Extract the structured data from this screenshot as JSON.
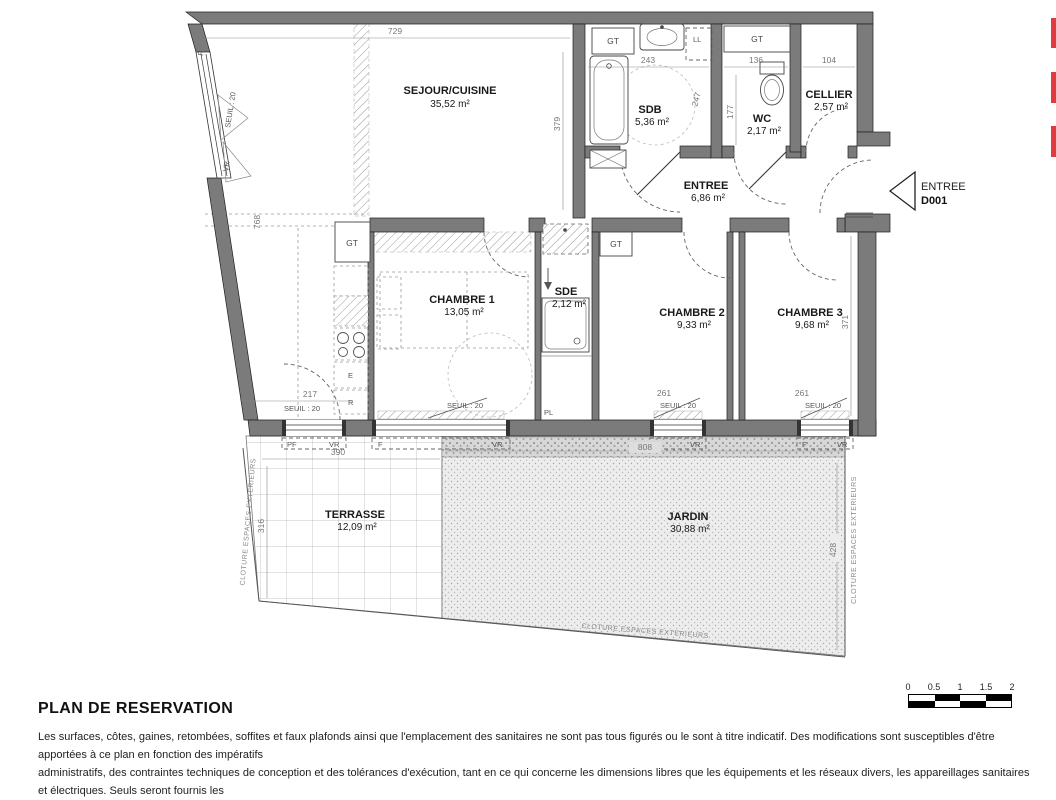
{
  "plan": {
    "rooms": {
      "sejour": {
        "name": "SEJOUR/CUISINE",
        "area": "35,52 m²"
      },
      "sdb": {
        "name": "SDB",
        "area": "5,36 m²"
      },
      "wc": {
        "name": "WC",
        "area": "2,17 m²"
      },
      "cellier": {
        "name": "CELLIER",
        "area": "2,57 m²"
      },
      "entree": {
        "name": "ENTREE",
        "area": "6,86 m²"
      },
      "chambre1": {
        "name": "CHAMBRE 1",
        "area": "13,05 m²"
      },
      "sde": {
        "name": "SDE",
        "area": "2,12 m²"
      },
      "chambre2": {
        "name": "CHAMBRE 2",
        "area": "9,33 m²"
      },
      "chambre3": {
        "name": "CHAMBRE 3",
        "area": "9,68 m²"
      },
      "terrasse": {
        "name": "TERRASSE",
        "area": "12,09 m²"
      },
      "jardin": {
        "name": "JARDIN",
        "area": "30,88 m²"
      }
    },
    "entry": {
      "label": "ENTREE",
      "door_code": "D001"
    },
    "dims": {
      "sejour_w": "729",
      "sejour_h": "379",
      "sdb_w": "243",
      "sdb_h": "247",
      "wc_w": "136",
      "wc_h": "177",
      "cellier_w": "104",
      "left_h": "768",
      "corridor_w": "217",
      "ch2_sill": "261",
      "ch3_sill": "261",
      "ch3_h": "371",
      "terrasse_w": "390",
      "terrasse_h": "316",
      "jardin_w": "808",
      "jardin_h": "428"
    },
    "labels": {
      "gt": "GT",
      "ll": "LL",
      "pl": "PL",
      "f": "F",
      "pf": "PF",
      "vr": "VR",
      "seuil": "SEUIL : 20",
      "cloture": "CLOTURE ESPACES EXTERIEURS"
    }
  },
  "footer": {
    "title": "PLAN DE RESERVATION",
    "disclaimer_lines": [
      "Les surfaces, côtes, gaines, retombées, soffites et faux plafonds ainsi que l'emplacement des sanitaires ne sont pas tous figurés ou le sont à titre indicatif. Des modifications sont susceptibles d'être apportées à ce plan en fonction des impératifs",
      "administratifs, des contraintes techniques de conception et des tolérances d'exécution, tant en ce qui concerne les dimensions libres que les équipements et les réseaux divers, les appareillages sanitaires et électriques. Seuls seront fournis les",
      "équipements figurant sur le descriptif en annexe de l'acte de vente."
    ]
  },
  "scalebar": {
    "ticks": [
      "0",
      "0.5",
      "1",
      "1.5",
      "2"
    ]
  },
  "colors": {
    "wall": "#7b7b7b",
    "red_marker": "#e23b3f"
  }
}
